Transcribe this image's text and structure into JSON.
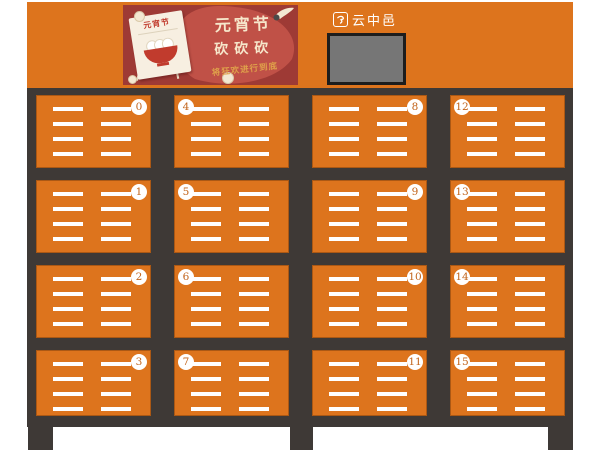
{
  "brand": {
    "name": "云中邑"
  },
  "banner": {
    "calendar_title": "元宵节",
    "title_line1": "元宵节",
    "title_line2": "砍砍砍",
    "subtitle": "将狂欢进行到底"
  },
  "lockers": {
    "rows": [
      [
        "0",
        "4",
        "8",
        "12"
      ],
      [
        "1",
        "5",
        "9",
        "13"
      ],
      [
        "2",
        "6",
        "10",
        "14"
      ],
      [
        "3",
        "7",
        "11",
        "15"
      ]
    ]
  },
  "colors": {
    "cabinet_orange": "#dd741d",
    "frame_dark": "#3e3936",
    "banner_red": "#9e3a35",
    "banner_blob": "#c05147",
    "banner_cream": "#f6e7cb",
    "banner_gold": "#dfa04a",
    "bowl_red": "#c13b2d",
    "screen_gray": "#767676",
    "badge_number": "#c2641b"
  }
}
